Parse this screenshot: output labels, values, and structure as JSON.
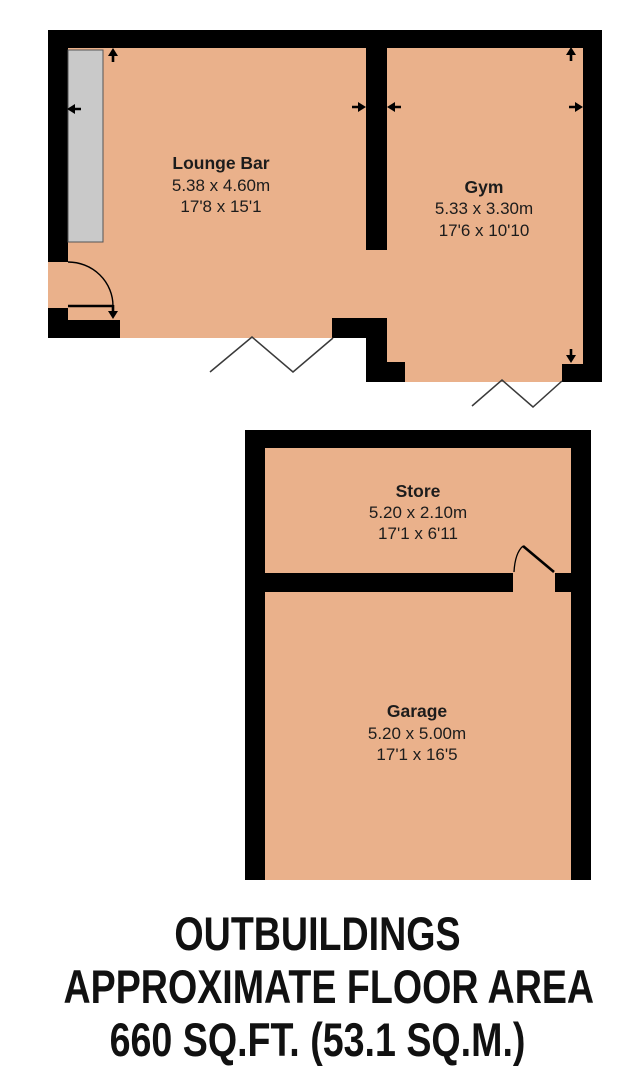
{
  "plan": {
    "rooms": [
      {
        "name": "Lounge Bar",
        "size_metric": "5.38 x 4.60m",
        "size_imperial": "17'8 x 15'1"
      },
      {
        "name": "Gym",
        "size_metric": "5.33 x 3.30m",
        "size_imperial": "17'6 x 10'10"
      },
      {
        "name": "Store",
        "size_metric": "5.20 x 2.10m",
        "size_imperial": "17'1 x 6'11"
      },
      {
        "name": "Garage",
        "size_metric": "5.20 x 5.00m",
        "size_imperial": "17'1 x 16'5"
      }
    ]
  },
  "caption": {
    "line1": "OUTBUILDINGS",
    "line2": "APPROXIMATE FLOOR AREA",
    "line3": "660 SQ.FT. (53.1 SQ.M.)"
  },
  "colors": {
    "floor": "#EAB18B",
    "wall": "#000000",
    "window": "#C9C9C9",
    "break_line": "#3A3A3A",
    "label_text": "#1C1C1C",
    "background": "#FFFFFF"
  }
}
